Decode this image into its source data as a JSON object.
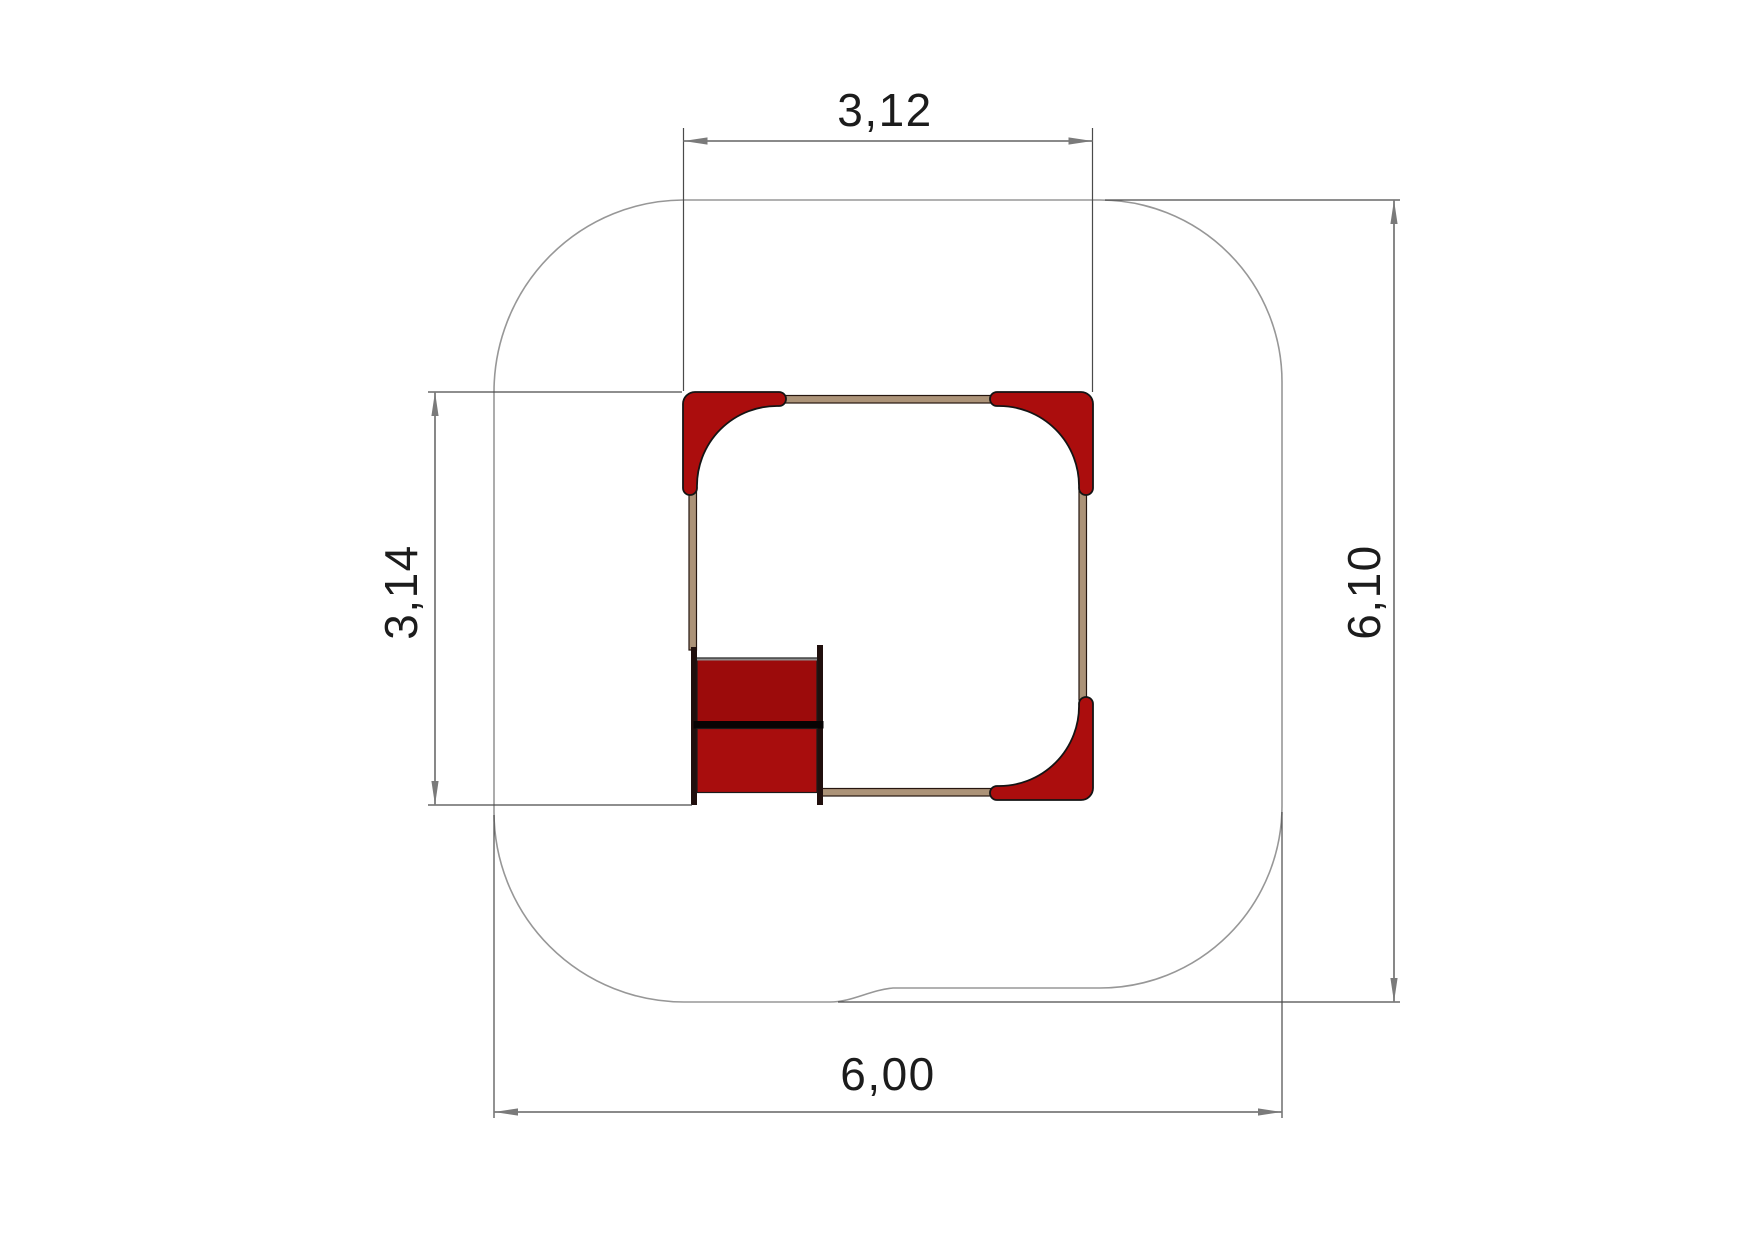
{
  "drawing": {
    "title": "playground equipment plan view with safety zone and dimensions",
    "dimension_labels": {
      "structure_width": "3,12",
      "structure_depth": "3,14",
      "safety_zone_height": "6,10",
      "safety_zone_width": "6,00"
    },
    "colors": {
      "seat_red": "#ab0d0d",
      "panel_red_upper": "#9c0b0b",
      "panel_red_lower": "#a80d0d",
      "beam_tan": "#ac9378",
      "post_dark": "#200f0d",
      "divider_black": "#070303",
      "outline_gray": "#979797",
      "dimension_gray": "#7a7a7a",
      "extension_dark": "#4a4a4a",
      "label_text": "#1c1c1c"
    }
  }
}
